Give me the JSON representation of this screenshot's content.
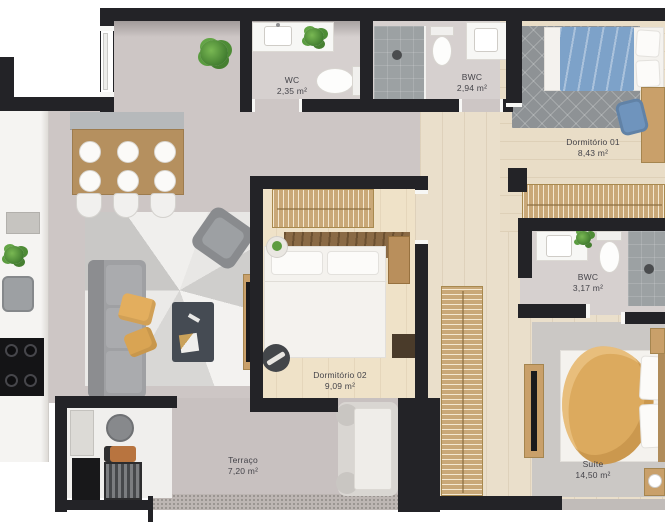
{
  "floorplan": {
    "rooms": [
      {
        "name": "WC",
        "area": "2,35 m²"
      },
      {
        "name": "BWC",
        "area": "2,94 m²"
      },
      {
        "name": "Dormitório 01",
        "area": "8,43 m²"
      },
      {
        "name": "BWC",
        "area": "3,17 m²"
      },
      {
        "name": "Dormitório 02",
        "area": "9,09 m²"
      },
      {
        "name": "Terraço",
        "area": "7,20 m²"
      },
      {
        "name": "Suíte",
        "area": "14,50 m²"
      }
    ],
    "colors": {
      "wall": "#232327",
      "wood_floor": "#eadfcb",
      "living_floor": "#cdc6c5",
      "shower_tile": "#9ca1a3",
      "rug_dark": "#8e9295",
      "blanket_blue": "#7da2c9",
      "blanket_yellow": "#dcaa5e",
      "pillow_yellow": "#e3ae5e",
      "plant_green": "#55953c",
      "wardrobe_wood": "#c9a878"
    }
  }
}
